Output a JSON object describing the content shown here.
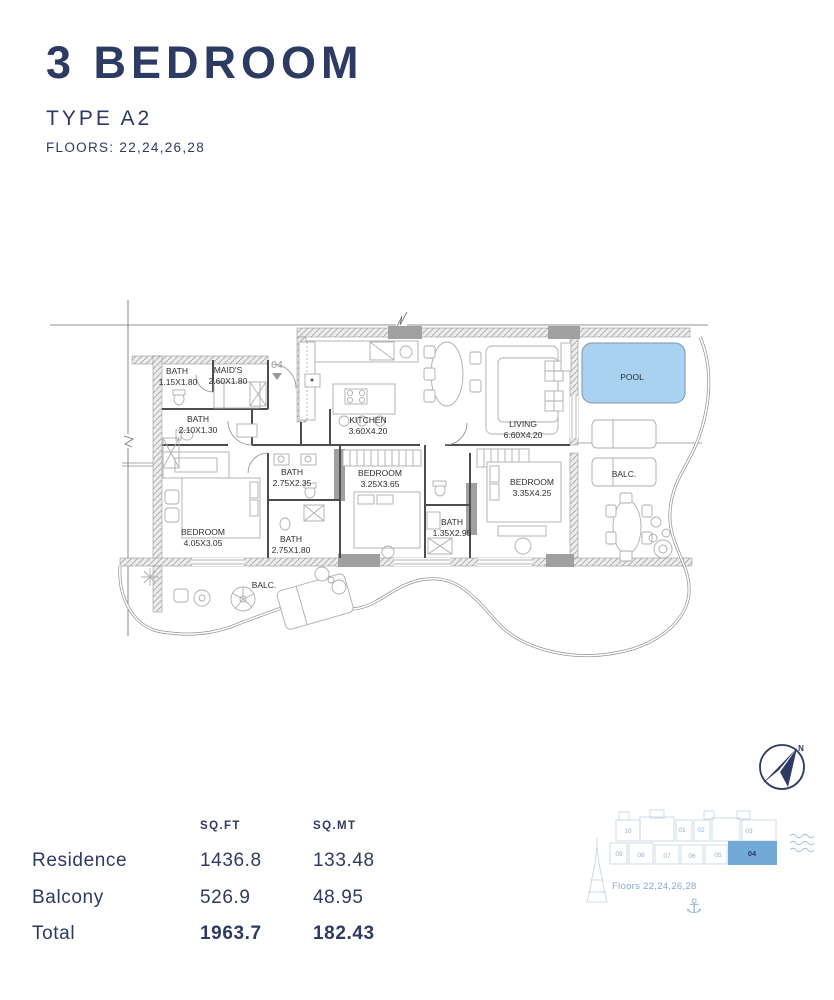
{
  "header": {
    "title": "3 BEDROOM",
    "unit_type": "TYPE A2",
    "floors": "FLOORS: 22,24,26,28"
  },
  "plan": {
    "unit_marker": "04",
    "rooms": [
      {
        "name": "BATH",
        "dims": "1.15X1.80"
      },
      {
        "name": "MAID'S",
        "dims": "2.60X1.80"
      },
      {
        "name": "BATH",
        "dims": "2.10X1.30"
      },
      {
        "name": "KITCHEN",
        "dims": "3.60X4.20"
      },
      {
        "name": "LIVING",
        "dims": "6.60X4.20"
      },
      {
        "name": "POOL",
        "dims": ""
      },
      {
        "name": "BALC.",
        "dims": ""
      },
      {
        "name": "BATH",
        "dims": "2.75X2.35"
      },
      {
        "name": "BEDROOM",
        "dims": "3.25X3.65"
      },
      {
        "name": "BEDROOM",
        "dims": "3.35X4.25"
      },
      {
        "name": "BATH",
        "dims": "1.35X2.95"
      },
      {
        "name": "BEDROOM",
        "dims": "4.05X3.05"
      },
      {
        "name": "BATH",
        "dims": "2.75X1.80"
      },
      {
        "name": "BALC.",
        "dims": ""
      }
    ],
    "pool_color": "#a9d2f1"
  },
  "compass": {
    "north_label": "N"
  },
  "area_table": {
    "col_headers": [
      "SQ.FT",
      "SQ.MT"
    ],
    "rows": [
      {
        "label": "Residence",
        "sqft": "1436.8",
        "sqmt": "133.48"
      },
      {
        "label": "Balcony",
        "sqft": "526.9",
        "sqmt": "48.95"
      },
      {
        "label": "Total",
        "sqft": "1963.7",
        "sqmt": "182.43"
      }
    ]
  },
  "keyplan": {
    "units_top": [
      "10",
      "01",
      "02",
      "03"
    ],
    "units_bottom": [
      "09",
      "08",
      "07",
      "06",
      "05"
    ],
    "highlighted_unit": "04",
    "highlight_color": "#72a9d6",
    "floors_note": "Floors 22,24,26,28",
    "anchor_icon": "⚓"
  },
  "colors": {
    "navy": "#2d3a62",
    "pool_blue": "#a9d2f1",
    "keyplan_highlight": "#72a9d6",
    "light_blue_text": "#85a9cc"
  }
}
